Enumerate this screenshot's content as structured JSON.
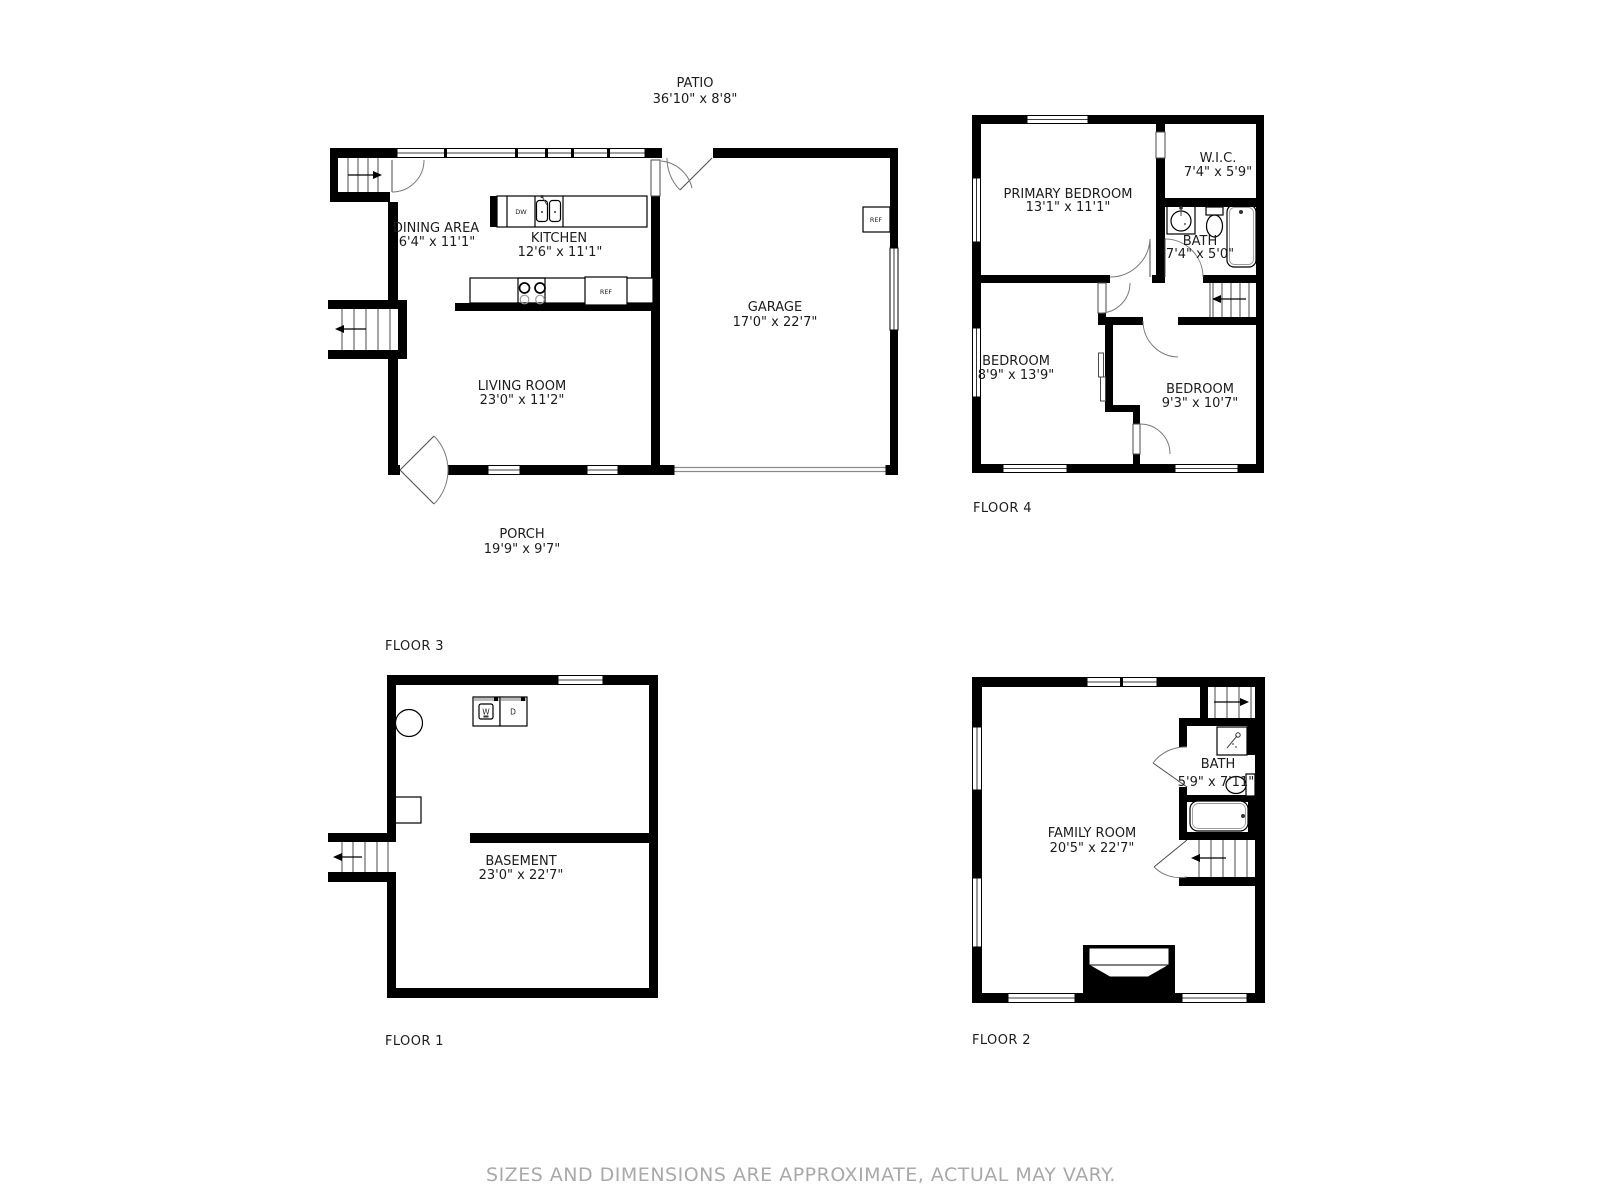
{
  "disclaimer": "SIZES AND DIMENSIONS ARE APPROXIMATE, ACTUAL MAY VARY.",
  "colors": {
    "wall": "#000000",
    "label": "#1c1c1c",
    "muted_text": "#a9a9a9",
    "background": "#ffffff"
  },
  "floors": {
    "floor3": {
      "label": "FLOOR 3",
      "patio": {
        "name": "PATIO",
        "dims": "36'10\" x 8'8\""
      },
      "dining": {
        "name": "DINING AREA",
        "dims": "6'4\" x 11'1\""
      },
      "kitchen": {
        "name": "KITCHEN",
        "dims": "12'6\" x 11'1\""
      },
      "garage": {
        "name": "GARAGE",
        "dims": "17'0\" x 22'7\""
      },
      "living": {
        "name": "LIVING ROOM",
        "dims": "23'0\" x 11'2\""
      },
      "porch": {
        "name": "PORCH",
        "dims": "19'9\" x 9'7\""
      },
      "fixture_labels": {
        "dishwasher": "DW",
        "fridge": "REF"
      }
    },
    "floor4": {
      "label": "FLOOR 4",
      "primary": {
        "name": "PRIMARY BEDROOM",
        "dims": "13'1\" x 11'1\""
      },
      "wic": {
        "name": "W.I.C.",
        "dims": "7'4\" x 5'9\""
      },
      "bath": {
        "name": "BATH",
        "dims": "7'4\" x 5'0\""
      },
      "bedroom_left": {
        "name": "BEDROOM",
        "dims": "8'9\" x 13'9\""
      },
      "bedroom_right": {
        "name": "BEDROOM",
        "dims": "9'3\" x 10'7\""
      }
    },
    "floor1": {
      "label": "FLOOR 1",
      "basement": {
        "name": "BASEMENT",
        "dims": "23'0\" x 22'7\""
      },
      "fixture_labels": {
        "washer": "W",
        "dryer": "D"
      }
    },
    "floor2": {
      "label": "FLOOR 2",
      "family": {
        "name": "FAMILY ROOM",
        "dims": "20'5\" x 22'7\""
      },
      "bath": {
        "name": "BATH",
        "dims": "5'9\" x 7'11\""
      }
    }
  }
}
